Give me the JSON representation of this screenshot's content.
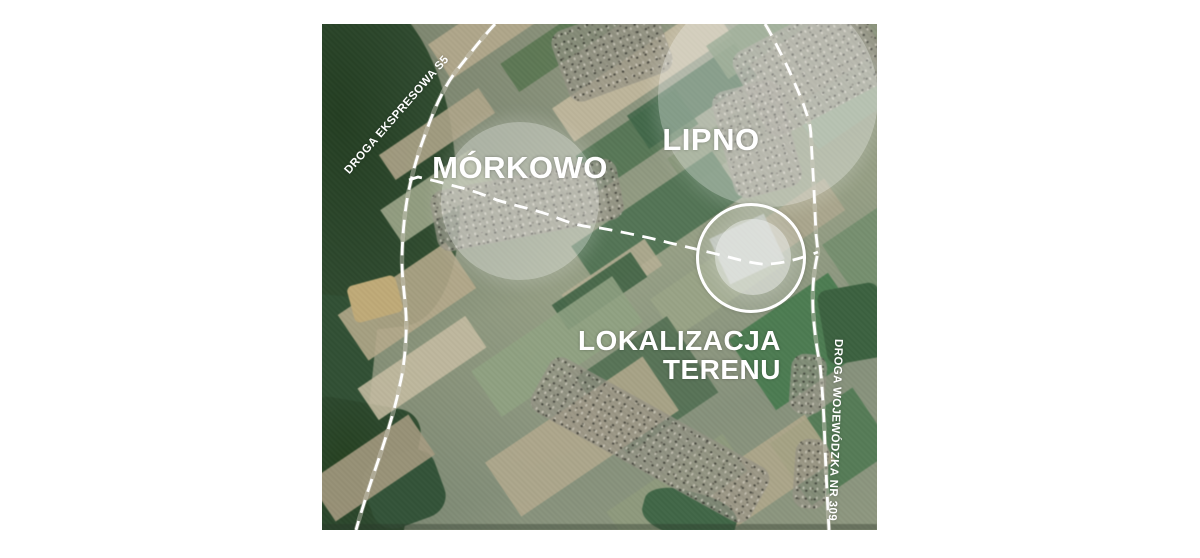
{
  "map": {
    "title": "satellite location map",
    "labels": {
      "morkowo": "MÓRKOWO",
      "lipno": "LIPNO",
      "location": {
        "line1": "LOKALIZACJA",
        "line2": "TERENU"
      },
      "road_s5": "DROGA EKSPRESOWA S5",
      "road_309": "DROGA WOJEWÓDZKA NR 309"
    },
    "annotation_color": "#ffffff",
    "highlight_fill": "rgba(255,255,255,0.35)"
  }
}
